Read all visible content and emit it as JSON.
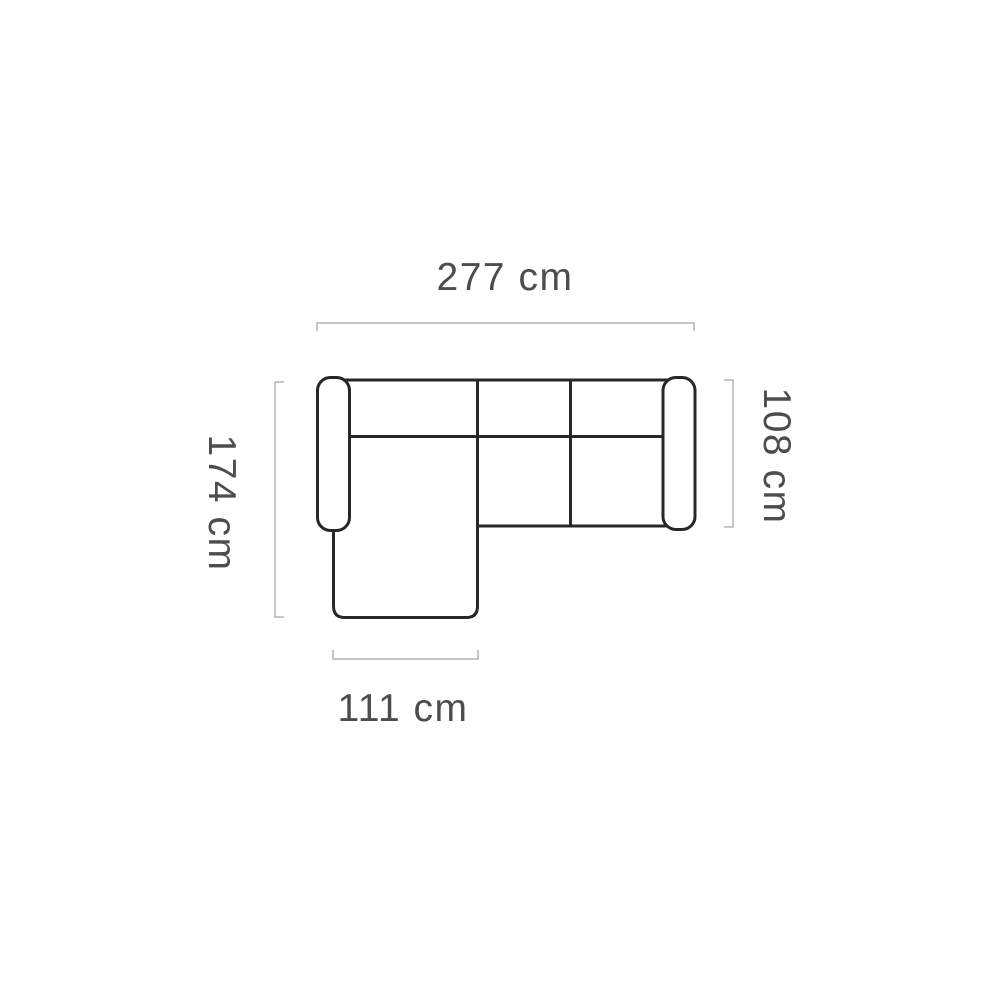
{
  "diagram": {
    "kind": "sofa-top-view-dimension-drawing",
    "labels": {
      "total_width": "277 cm",
      "total_depth": "174 cm",
      "body_depth": "108 cm",
      "chaise_width": "111 cm"
    },
    "colors": {
      "outline": "#272727",
      "dimension_line": "#b4b4b4",
      "label_text": "#4d4d4d",
      "background": "#ffffff"
    }
  }
}
